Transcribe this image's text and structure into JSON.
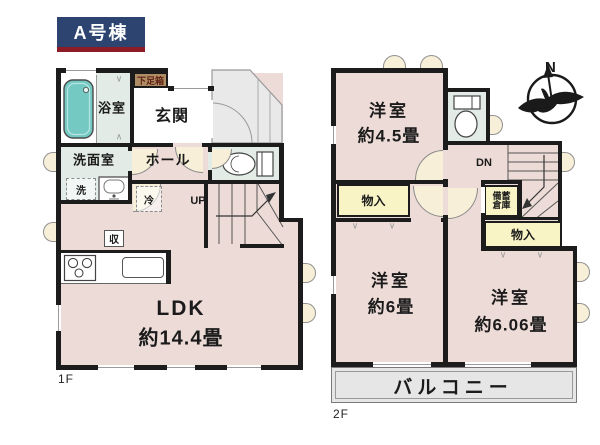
{
  "title": "A号棟",
  "colors": {
    "wall": "#1c1c1c",
    "room_pink": "#eddbd7",
    "wet_mint": "#e2ebe6",
    "closet_yellow": "#f8f4c6",
    "tub_teal": "#74c9c3",
    "porch_gray": "#e9e9e9",
    "balcony_gray": "#e6e6e6",
    "title_navy": "#2d4470",
    "title_red": "#8e1c26",
    "shoebox_tan": "#ae8d65",
    "door_beige": "#f7efd8"
  },
  "floor1": {
    "label": "1F",
    "shoebox": "下足箱",
    "entrance": "玄関",
    "bathroom": "浴室",
    "washroom": "洗面室",
    "washer": "洗",
    "hall": "ホール",
    "fridge": "冷",
    "stairs_dir": "UP",
    "storage": "収",
    "ldk_name": "LDK",
    "ldk_size": "約14.4畳"
  },
  "floor2": {
    "label": "2F",
    "room45_name": "洋室",
    "room45_size": "約4.5畳",
    "closet_left": "物入",
    "stock_line1": "備蓄",
    "stock_line2": "倉庫",
    "closet_right": "物入",
    "stairs_dir": "DN",
    "room6_name": "洋室",
    "room6_size": "約6畳",
    "room606_name": "洋室",
    "room606_size": "約6.06畳",
    "balcony": "バルコニー"
  },
  "compass": {
    "north": "N"
  }
}
